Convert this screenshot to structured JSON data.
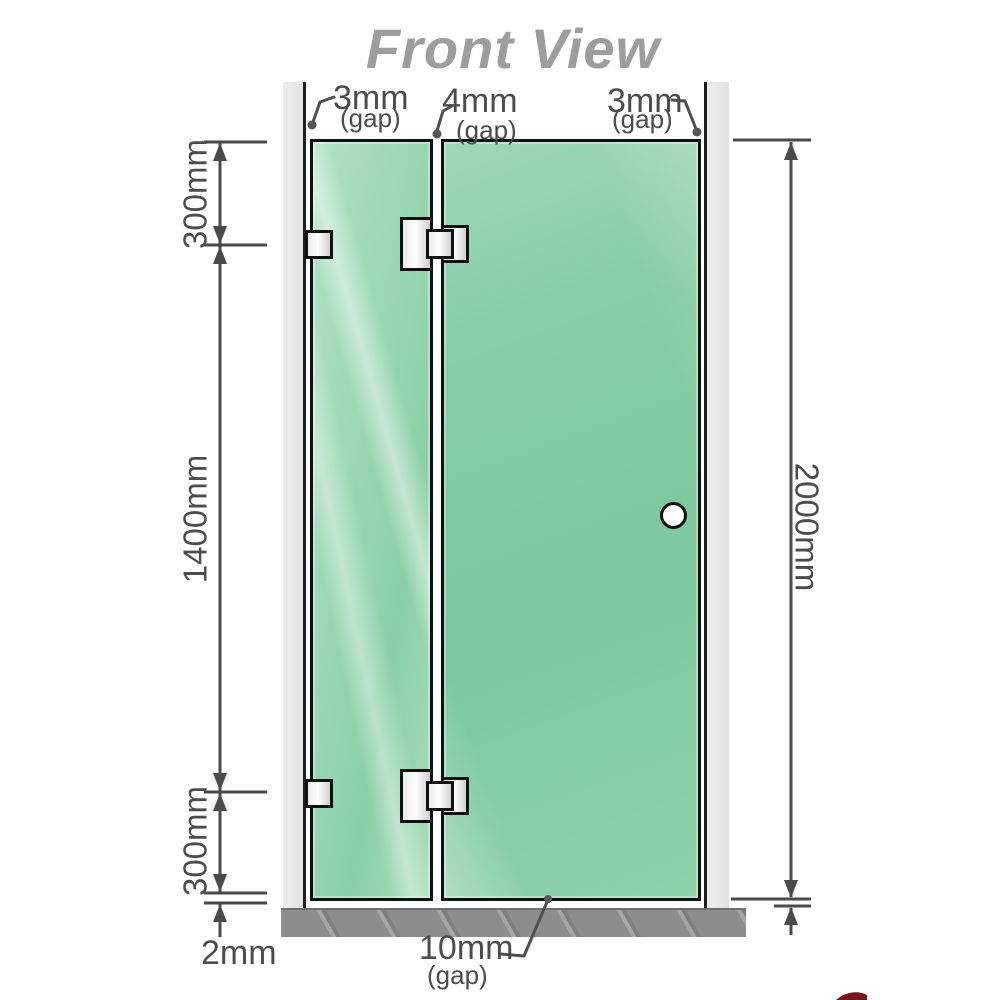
{
  "title": "Front View",
  "annotations": {
    "gap_top_left": {
      "value": "3mm",
      "note": "(gap)"
    },
    "gap_top_middle": {
      "value": "4mm",
      "note": "(gap)"
    },
    "gap_top_right": {
      "value": "3mm",
      "note": "(gap)"
    },
    "gap_bottom": {
      "value": "10mm",
      "note": "(gap)"
    },
    "floor_offset": {
      "value": "2mm"
    }
  },
  "dimensions": {
    "left_top": "300mm",
    "left_middle": "1400mm",
    "left_bottom": "300mm",
    "right_total": "2000mm"
  },
  "colors": {
    "glass_green": "#7cc8a0",
    "glass_green_light": "#b2e2c6",
    "wall_channel_gray": "#e6e6e6",
    "floor_gray": "#8d8d8d",
    "dimension_line": "#4a4a4a",
    "title_gray": "#9d9d9d",
    "hardware_metal": "#ffffff",
    "outline_black": "#101010",
    "logo_red": "#7a1518"
  }
}
